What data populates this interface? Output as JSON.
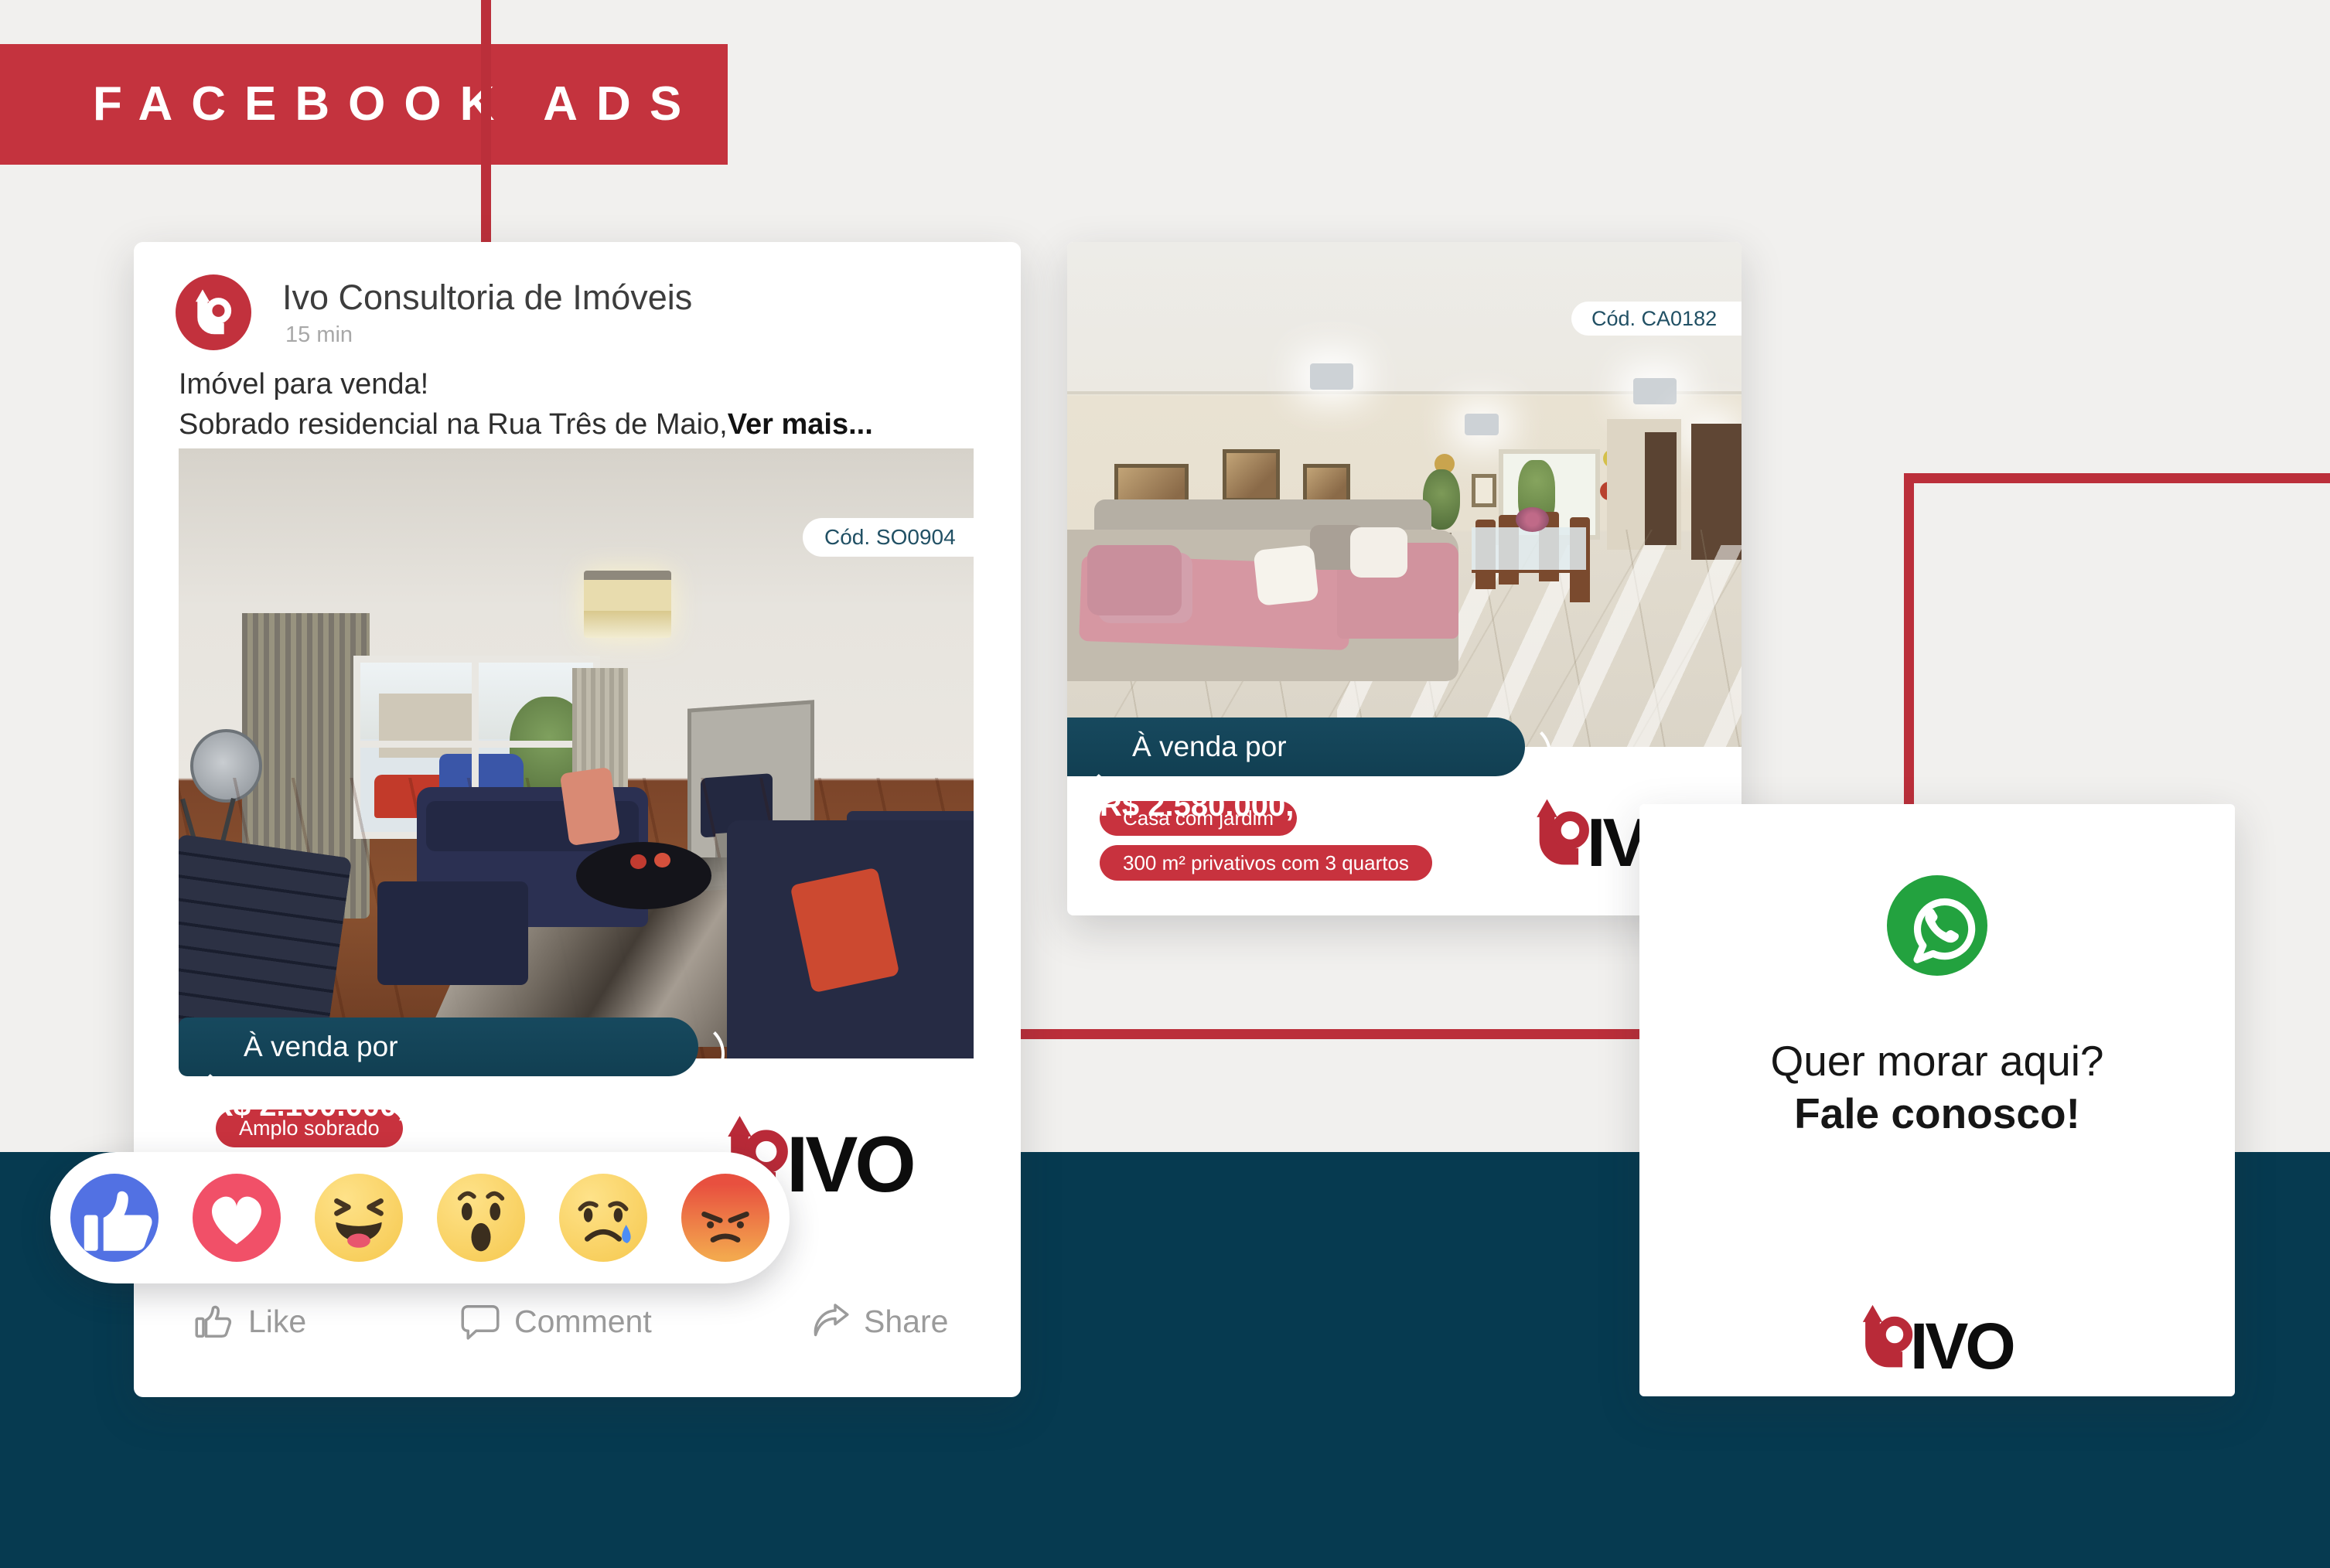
{
  "header": {
    "title": "FACEBOOK ADS"
  },
  "post": {
    "brand": "Ivo Consultoria de Imóveis",
    "timestamp": "15 min",
    "body_line1": "Imóvel para venda!",
    "body_line2": "Sobrado residencial na Rua Três de Maio,",
    "see_more": "Ver mais...",
    "photo_code": "Cód. SO0904",
    "price_prefix": "À venda por ",
    "price": "R$ 2.100.000,00",
    "tag": "Amplo sobrado",
    "logo_text": "IVO",
    "actions": {
      "like": "Like",
      "comment": "Comment",
      "share": "Share"
    }
  },
  "ad2": {
    "photo_code": "Cód. CA0182",
    "price_prefix": "À venda por ",
    "price": "R$ 2.580.000,00",
    "tags": [
      "Casa com jardim",
      "300 m² privativos com 3 quartos"
    ],
    "logo_text": "IVO"
  },
  "ad3": {
    "headline": "Quer morar aqui?",
    "cta": "Fale conosco!",
    "logo_text": "IVO"
  },
  "reactions": {
    "names": [
      "like",
      "love",
      "haha",
      "wow",
      "sad",
      "angry"
    ]
  },
  "colors": {
    "brand_red": "#c4333e",
    "logo_red": "#b92a38",
    "ribbon_teal": "#17495e",
    "band_teal": "#063a50",
    "whatsapp_green": "#23a23f",
    "badge_text": "#215064"
  }
}
